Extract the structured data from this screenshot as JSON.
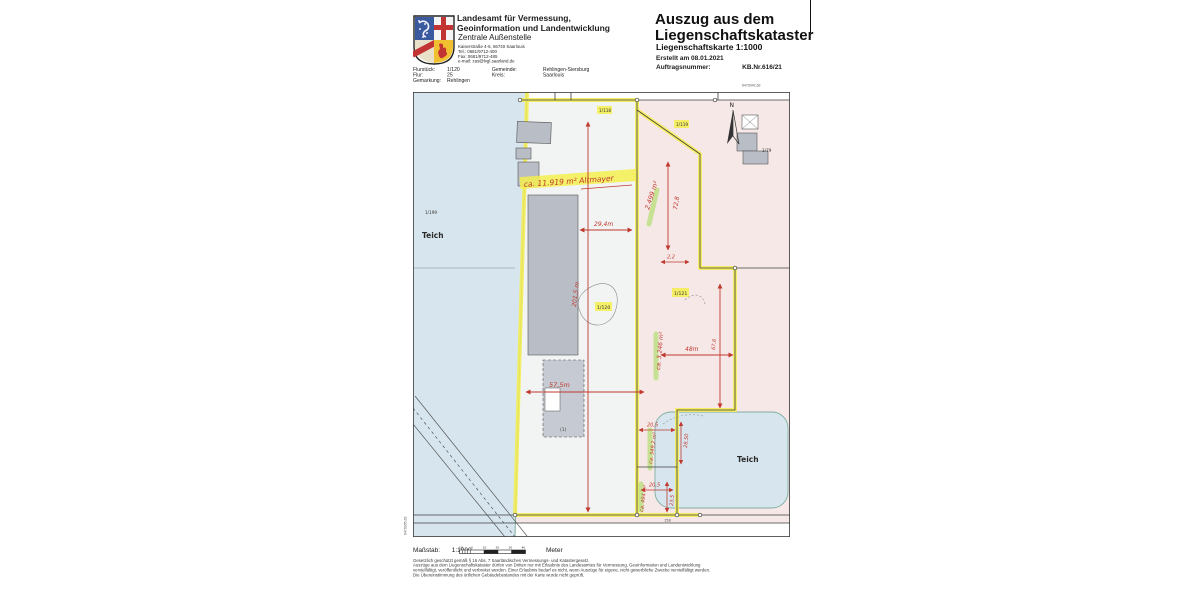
{
  "page": {
    "agency": {
      "name_line1": "Landesamt für Vermessung,",
      "name_line2": "Geoinformation und Landentwicklung",
      "office": "Zentrale Außenstelle",
      "address": "Kaiserstraße 4-6, 66740 Saarlouis",
      "tel": "Tel.: 0681/9712-400",
      "fax": "Fax: 0681/9712-485",
      "email": "e-mail: zas@lvgl.saarland.de"
    },
    "title": {
      "line1": "Auszug aus dem",
      "line2": "Liegenschaftskataster",
      "subtitle": "Liegenschaftskarte  1:1000",
      "created": "Erstellt am  08.01.2021",
      "order_label": "Auftragsnummer:",
      "order_value": "KB.Nr.616/21"
    },
    "fields": {
      "flurstueck_label": "Flurstück:",
      "flurstueck_value": "1/120",
      "flur_label": "Flur:",
      "flur_value": "25",
      "gemarkung_label": "Gemarkung:",
      "gemarkung_value": "Rehlingen",
      "gemeinde_label": "Gemeinde:",
      "gemeinde_value": "Rehlingen-Siersburg",
      "kreis_label": "Kreis:",
      "kreis_value": "Saarlouis"
    }
  },
  "map": {
    "coordinates": {
      "top_right": "6470042,63",
      "right_edge": "2570340,00",
      "bottom_left": "6470005,63"
    },
    "labels": {
      "teich_left": "Teich",
      "teich_right": "Teich",
      "parcel_water": "1/199",
      "parcel_top_a": "1/118",
      "parcel_top_b": "1/119",
      "parcel_center": "1/120",
      "parcel_right": "1/121",
      "parcel_ne": "1/79",
      "north": "N",
      "building_ref": "(1)",
      "street_number": "158"
    },
    "annotations": {
      "area_note": "ca. 11.919 m² Altmayer",
      "width_top": "29,4m",
      "area_upper_right": "2.499 m²",
      "depth_upper_right": "72,8",
      "gap": "2,2",
      "length_left": "201,5 m",
      "area_right": "ca. 3.246 m²",
      "width_right": "48m",
      "depth_right": "67,6",
      "width_bottom": "57,5m",
      "notch1_width": "20,5",
      "notch1_depth": "28,50",
      "notch1_area": "ca. 549,2 m²",
      "notch2_width": "20,5",
      "notch2_depth": "23,5",
      "notch2_area": "ca. 494 m²"
    },
    "colors": {
      "highlight_yellow": "#f5ee4e",
      "highlight_green": "#9fdc4e",
      "annotation_red": "#c0392e",
      "water_blue": "#d7e6ee",
      "parcel_pink": "#f7e8e8",
      "building_gray": "#b9bdc5"
    }
  },
  "footer": {
    "scale_label": "Maßstab:",
    "scale_value": "1:1000",
    "meter_label": "Meter",
    "scalebar_ticks": [
      "10",
      "0",
      "10",
      "20",
      "30",
      "40"
    ],
    "legal": [
      "Gesetzlich geschützt gemäß § 16 Abs. 7 Saarländisches Vermessungs- und Katastergesetz.",
      "Auszüge aus dem Liegenschaftskataster dürfen von Dritten nur mit Erlaubnis des Landesamtes für Vermessung, Geoinformation und Landentwicklung",
      "vervielfältigt, veröffentlicht und verbreitet werden. Einer Erlaubnis bedarf es nicht, wenn Auszüge für eigene, nicht gewerbliche Zwecke vervielfältigt werden.",
      "Die Übereinstimmung des örtlichen Gebäudebestandes mit der Karte wurde nicht geprüft."
    ]
  }
}
